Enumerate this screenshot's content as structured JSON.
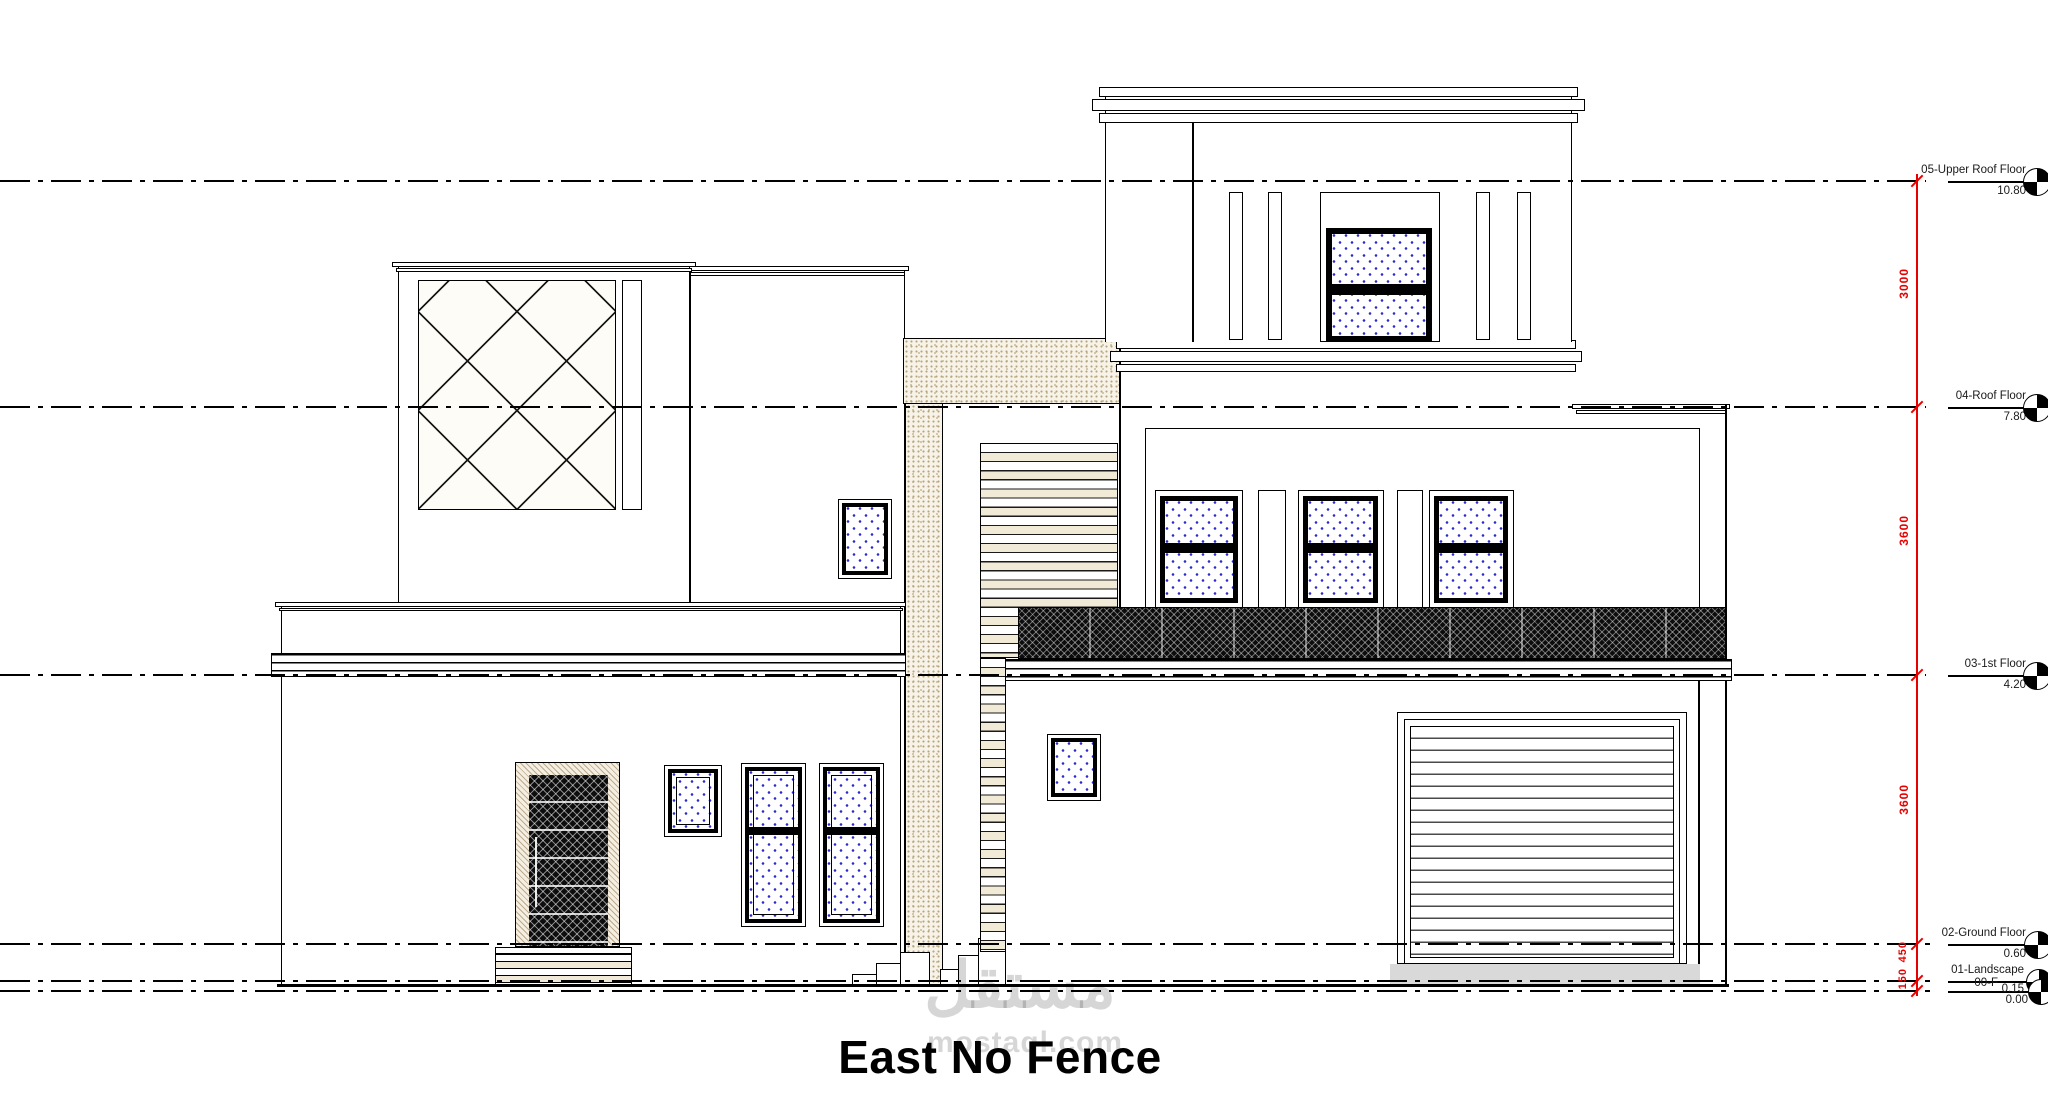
{
  "drawing": {
    "title": "East No Fence",
    "levels": [
      {
        "name": "05-Upper Roof Floor",
        "value": "10.80"
      },
      {
        "name": "04-Roof Floor",
        "value": "7.80"
      },
      {
        "name": "03-1st Floor",
        "value": "4.20"
      },
      {
        "name": "02-Ground Floor",
        "value": "0.60"
      },
      {
        "name": "01-Landscape",
        "value": "0.15"
      },
      {
        "name": "00-F",
        "value": "0.00"
      }
    ],
    "dimensions": [
      "3000",
      "3600",
      "3600",
      "450",
      "150"
    ],
    "colors": {
      "dimension_red": "#e60000",
      "line_black": "#000000",
      "glass_hatch_blue": "#2b2bd0",
      "watermark_gray": "#bfbfbf",
      "driveway_gray": "#d9d9d9"
    }
  },
  "watermark": {
    "arabic": "مستقل",
    "latin": "mostaql.com"
  }
}
